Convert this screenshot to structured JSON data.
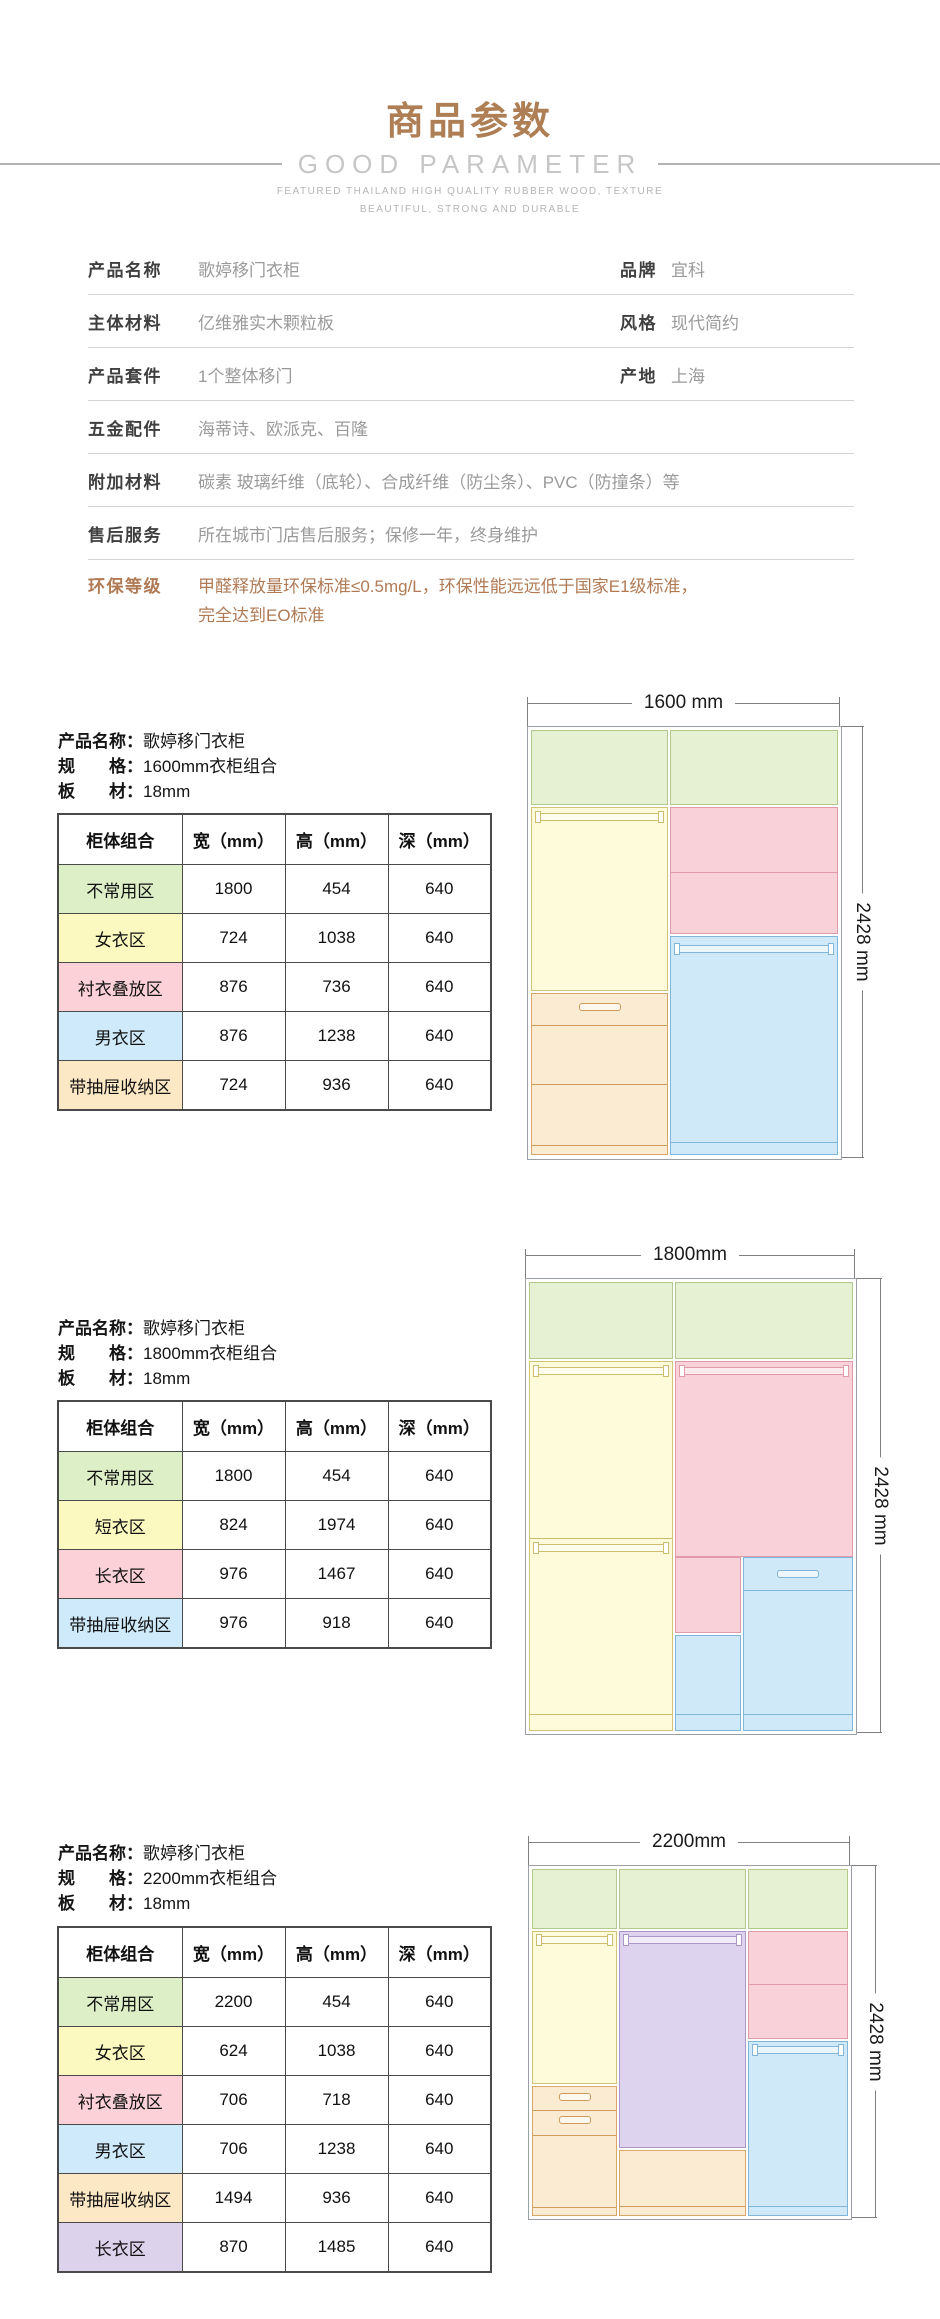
{
  "palette": {
    "accent_brown": "#ae7e54",
    "env_text_brown": "#b07a55",
    "zone_green": "#ddefc6",
    "zone_yellow": "#fbf8c0",
    "zone_pink": "#fcd2d8",
    "zone_blue": "#cfeafb",
    "zone_orange": "#fde8c5",
    "zone_purple": "#ddd2ec"
  },
  "header": {
    "title": "商品参数",
    "subtitle": "GOOD PARAMETER",
    "tagline_line1": "FEATURED THAILAND HIGH QUALITY RUBBER WOOD, TEXTURE",
    "tagline_line2": "BEAUTIFUL, STRONG AND DURABLE"
  },
  "specs": {
    "rows": [
      {
        "label": "产品名称",
        "value": "歌婷移门衣柜",
        "label2": "品牌",
        "value2": "宜科"
      },
      {
        "label": "主体材料",
        "value": "亿维雅实木颗粒板",
        "label2": "风格",
        "value2": "现代简约"
      },
      {
        "label": "产品套件",
        "value": "1个整体移门",
        "label2": "产地",
        "value2": "上海"
      },
      {
        "label": "五金配件",
        "value": "海蒂诗、欧派克、百隆"
      },
      {
        "label": "附加材料",
        "value": "碳素 玻璃纤维（底轮）、合成纤维（防尘条）、PVC（防撞条）等"
      },
      {
        "label": "售后服务",
        "value": "所在城市门店售后服务；保修一年，终身维护"
      },
      {
        "label": "环保等级",
        "value_line1": "甲醛释放量环保标准≤0.5mg/L，环保性能远远低于国家E1级标准，",
        "value_line2": "完全达到EO标准"
      }
    ]
  },
  "table_headers": [
    "柜体组合",
    "宽（mm）",
    "高（mm）",
    "深（mm）"
  ],
  "sections": [
    {
      "meta": {
        "name_label": "产品名称：",
        "name": "歌婷移门衣柜",
        "spec_label": "规　　格：",
        "spec": "1600mm衣柜组合",
        "board_label": "板　　材：",
        "board": "18mm"
      },
      "rows": [
        {
          "zone": "不常用区",
          "color": "green",
          "w": "1800",
          "h": "454",
          "d": "640"
        },
        {
          "zone": "女衣区",
          "color": "yellow",
          "w": "724",
          "h": "1038",
          "d": "640"
        },
        {
          "zone": "衬衣叠放区",
          "color": "pink",
          "w": "876",
          "h": "736",
          "d": "640"
        },
        {
          "zone": "男衣区",
          "color": "blue",
          "w": "876",
          "h": "1238",
          "d": "640"
        },
        {
          "zone": "带抽屉收纳区",
          "color": "orange",
          "w": "724",
          "h": "936",
          "d": "640"
        }
      ],
      "diagram": {
        "width_label": "1600 mm",
        "height_label": "2428 mm"
      }
    },
    {
      "meta": {
        "name_label": "产品名称：",
        "name": "歌婷移门衣柜",
        "spec_label": "规　　格：",
        "spec": "1800mm衣柜组合",
        "board_label": "板　　材：",
        "board": "18mm"
      },
      "rows": [
        {
          "zone": "不常用区",
          "color": "green",
          "w": "1800",
          "h": "454",
          "d": "640"
        },
        {
          "zone": "短衣区",
          "color": "yellow",
          "w": "824",
          "h": "1974",
          "d": "640"
        },
        {
          "zone": "长衣区",
          "color": "pink",
          "w": "976",
          "h": "1467",
          "d": "640"
        },
        {
          "zone": "带抽屉收纳区",
          "color": "blue",
          "w": "976",
          "h": "918",
          "d": "640"
        }
      ],
      "diagram": {
        "width_label": "1800mm",
        "height_label": "2428 mm"
      }
    },
    {
      "meta": {
        "name_label": "产品名称：",
        "name": "歌婷移门衣柜",
        "spec_label": "规　　格：",
        "spec": "2200mm衣柜组合",
        "board_label": "板　　材：",
        "board": "18mm"
      },
      "rows": [
        {
          "zone": "不常用区",
          "color": "green",
          "w": "2200",
          "h": "454",
          "d": "640"
        },
        {
          "zone": "女衣区",
          "color": "yellow",
          "w": "624",
          "h": "1038",
          "d": "640"
        },
        {
          "zone": "衬衣叠放区",
          "color": "pink",
          "w": "706",
          "h": "718",
          "d": "640"
        },
        {
          "zone": "男衣区",
          "color": "blue",
          "w": "706",
          "h": "1238",
          "d": "640"
        },
        {
          "zone": "带抽屉收纳区",
          "color": "orange",
          "w": "1494",
          "h": "936",
          "d": "640"
        },
        {
          "zone": "长衣区",
          "color": "purple",
          "w": "870",
          "h": "1485",
          "d": "640"
        }
      ],
      "diagram": {
        "width_label": "2200mm",
        "height_label": "2428 mm"
      }
    }
  ]
}
